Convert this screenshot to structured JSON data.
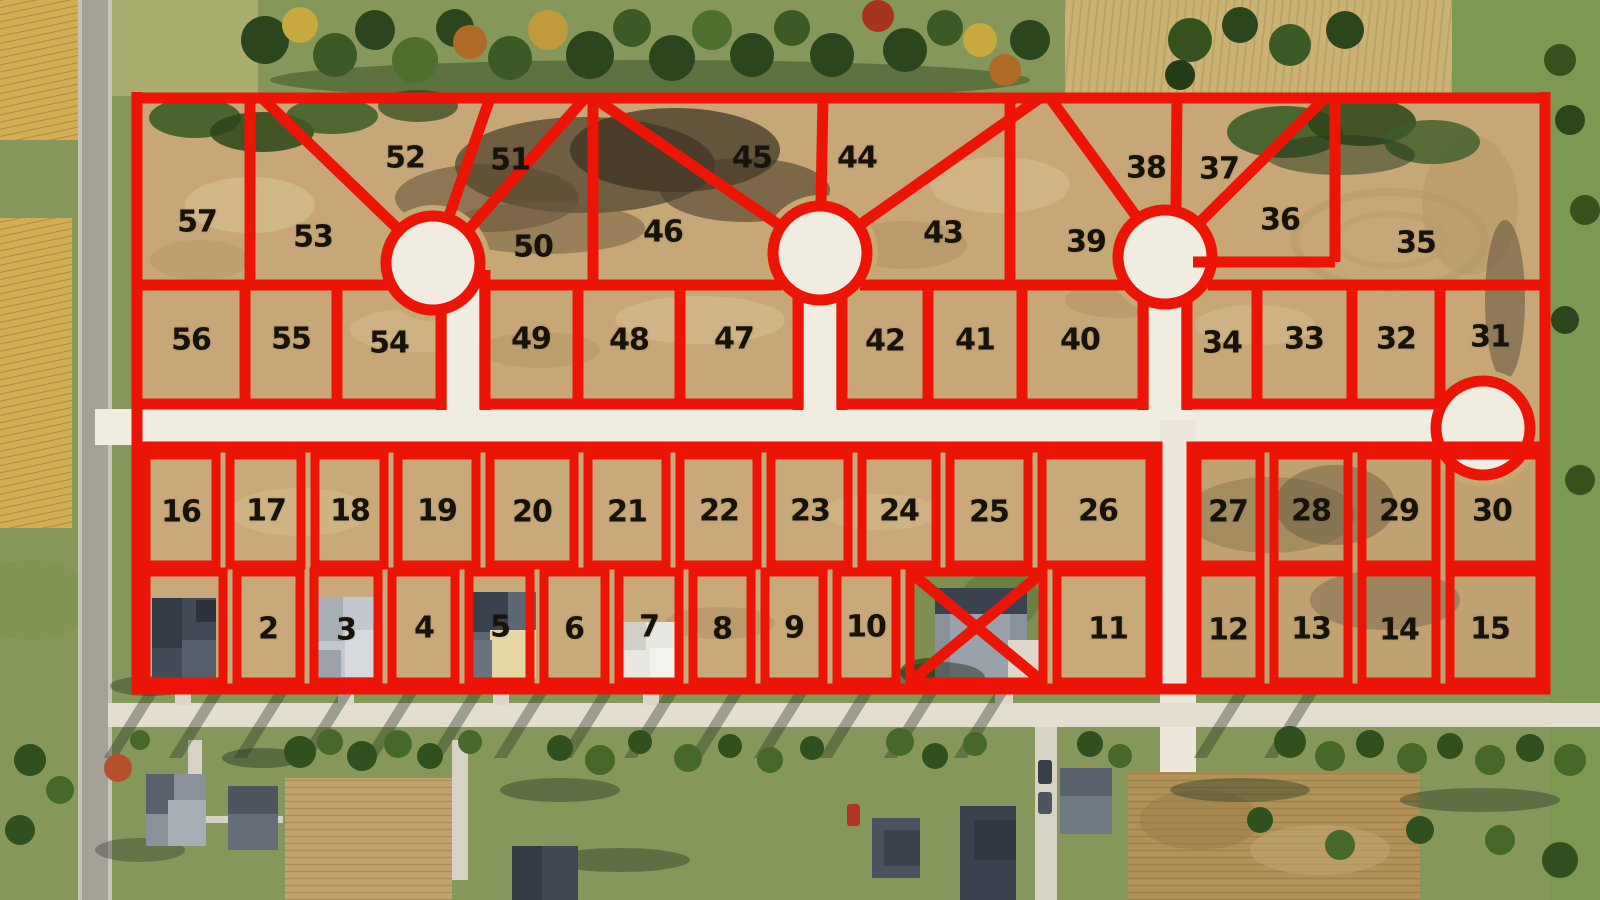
{
  "map": {
    "description": "Aerial subdivision plat map: numbered lots outlined in red over a satellite photo, three cul-de-sacs, one crossed-out (sold) lot between lots 10 and 11",
    "overlay_color": "#ec1407",
    "label_color": "#17130b",
    "road_color": "#f1ece0",
    "crossed_out_lot": {
      "marker": "X",
      "between_lots": [
        "10",
        "11"
      ]
    }
  },
  "lots": [
    {
      "label": "57",
      "x": 197,
      "y": 222
    },
    {
      "label": "53",
      "x": 313,
      "y": 237
    },
    {
      "label": "52",
      "x": 405,
      "y": 158
    },
    {
      "label": "51",
      "x": 510,
      "y": 160
    },
    {
      "label": "50",
      "x": 533,
      "y": 247
    },
    {
      "label": "46",
      "x": 663,
      "y": 232
    },
    {
      "label": "45",
      "x": 752,
      "y": 158
    },
    {
      "label": "44",
      "x": 857,
      "y": 158
    },
    {
      "label": "43",
      "x": 943,
      "y": 233
    },
    {
      "label": "39",
      "x": 1086,
      "y": 242
    },
    {
      "label": "38",
      "x": 1146,
      "y": 168
    },
    {
      "label": "37",
      "x": 1219,
      "y": 169
    },
    {
      "label": "36",
      "x": 1280,
      "y": 220
    },
    {
      "label": "35",
      "x": 1416,
      "y": 243
    },
    {
      "label": "56",
      "x": 191,
      "y": 340
    },
    {
      "label": "55",
      "x": 291,
      "y": 339
    },
    {
      "label": "54",
      "x": 389,
      "y": 343
    },
    {
      "label": "49",
      "x": 531,
      "y": 339
    },
    {
      "label": "48",
      "x": 629,
      "y": 340
    },
    {
      "label": "47",
      "x": 734,
      "y": 339
    },
    {
      "label": "42",
      "x": 885,
      "y": 341
    },
    {
      "label": "41",
      "x": 975,
      "y": 340
    },
    {
      "label": "40",
      "x": 1080,
      "y": 340
    },
    {
      "label": "34",
      "x": 1222,
      "y": 343
    },
    {
      "label": "33",
      "x": 1304,
      "y": 339
    },
    {
      "label": "32",
      "x": 1396,
      "y": 339
    },
    {
      "label": "31",
      "x": 1490,
      "y": 337
    },
    {
      "label": "16",
      "x": 181,
      "y": 512
    },
    {
      "label": "17",
      "x": 266,
      "y": 511
    },
    {
      "label": "18",
      "x": 350,
      "y": 511
    },
    {
      "label": "19",
      "x": 437,
      "y": 511
    },
    {
      "label": "20",
      "x": 532,
      "y": 512
    },
    {
      "label": "21",
      "x": 627,
      "y": 512
    },
    {
      "label": "22",
      "x": 719,
      "y": 511
    },
    {
      "label": "23",
      "x": 810,
      "y": 511
    },
    {
      "label": "24",
      "x": 899,
      "y": 511
    },
    {
      "label": "25",
      "x": 989,
      "y": 512
    },
    {
      "label": "26",
      "x": 1098,
      "y": 511
    },
    {
      "label": "27",
      "x": 1228,
      "y": 512
    },
    {
      "label": "28",
      "x": 1311,
      "y": 511
    },
    {
      "label": "29",
      "x": 1399,
      "y": 511
    },
    {
      "label": "30",
      "x": 1492,
      "y": 511
    },
    {
      "label": "2",
      "x": 268,
      "y": 629
    },
    {
      "label": "3",
      "x": 346,
      "y": 630
    },
    {
      "label": "4",
      "x": 424,
      "y": 628
    },
    {
      "label": "5",
      "x": 500,
      "y": 627
    },
    {
      "label": "6",
      "x": 574,
      "y": 629
    },
    {
      "label": "7",
      "x": 649,
      "y": 627
    },
    {
      "label": "8",
      "x": 722,
      "y": 629
    },
    {
      "label": "9",
      "x": 794,
      "y": 628
    },
    {
      "label": "10",
      "x": 866,
      "y": 627
    },
    {
      "label": "11",
      "x": 1108,
      "y": 629
    },
    {
      "label": "12",
      "x": 1228,
      "y": 630
    },
    {
      "label": "13",
      "x": 1311,
      "y": 629
    },
    {
      "label": "14",
      "x": 1399,
      "y": 630
    },
    {
      "label": "15",
      "x": 1490,
      "y": 629
    }
  ]
}
